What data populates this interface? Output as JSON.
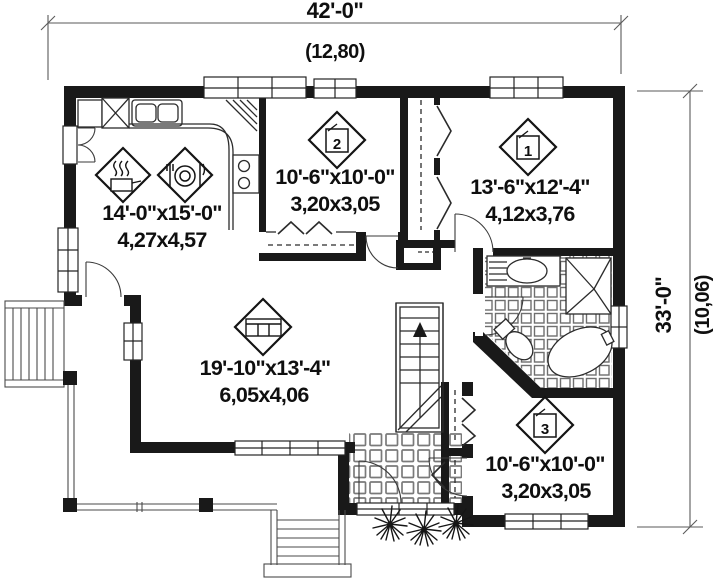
{
  "plan_title": "single-storey house floor plan",
  "dimensions": {
    "width_imperial": "42'-0\"",
    "width_metric": "(12,80)",
    "height_imperial": "33'-0\"",
    "height_metric": "(10,06)"
  },
  "rooms": {
    "kitchen": {
      "imperial": "14'-0\"x15'-0\"",
      "metric": "4,27x4,57",
      "icons": [
        "cooking-pot",
        "dining-plate"
      ]
    },
    "bedroom2": {
      "imperial": "10'-6\"x10'-0\"",
      "metric": "3,20x3,05",
      "number": "2"
    },
    "bedroom1": {
      "imperial": "13'-6\"x12'-4\"",
      "metric": "4,12x3,76",
      "number": "1"
    },
    "living": {
      "imperial": "19'-10\"x13'-4\"",
      "metric": "6,05x4,06",
      "icons": [
        "sofa"
      ]
    },
    "bedroom3": {
      "imperial": "10'-6\"x10'-0\"",
      "metric": "3,20x3,05",
      "number": "3"
    }
  },
  "colors": {
    "wall": "#191919",
    "dim_line": "#5a5a5a",
    "text": "#0f0f0f",
    "tile_line": "#707070"
  }
}
